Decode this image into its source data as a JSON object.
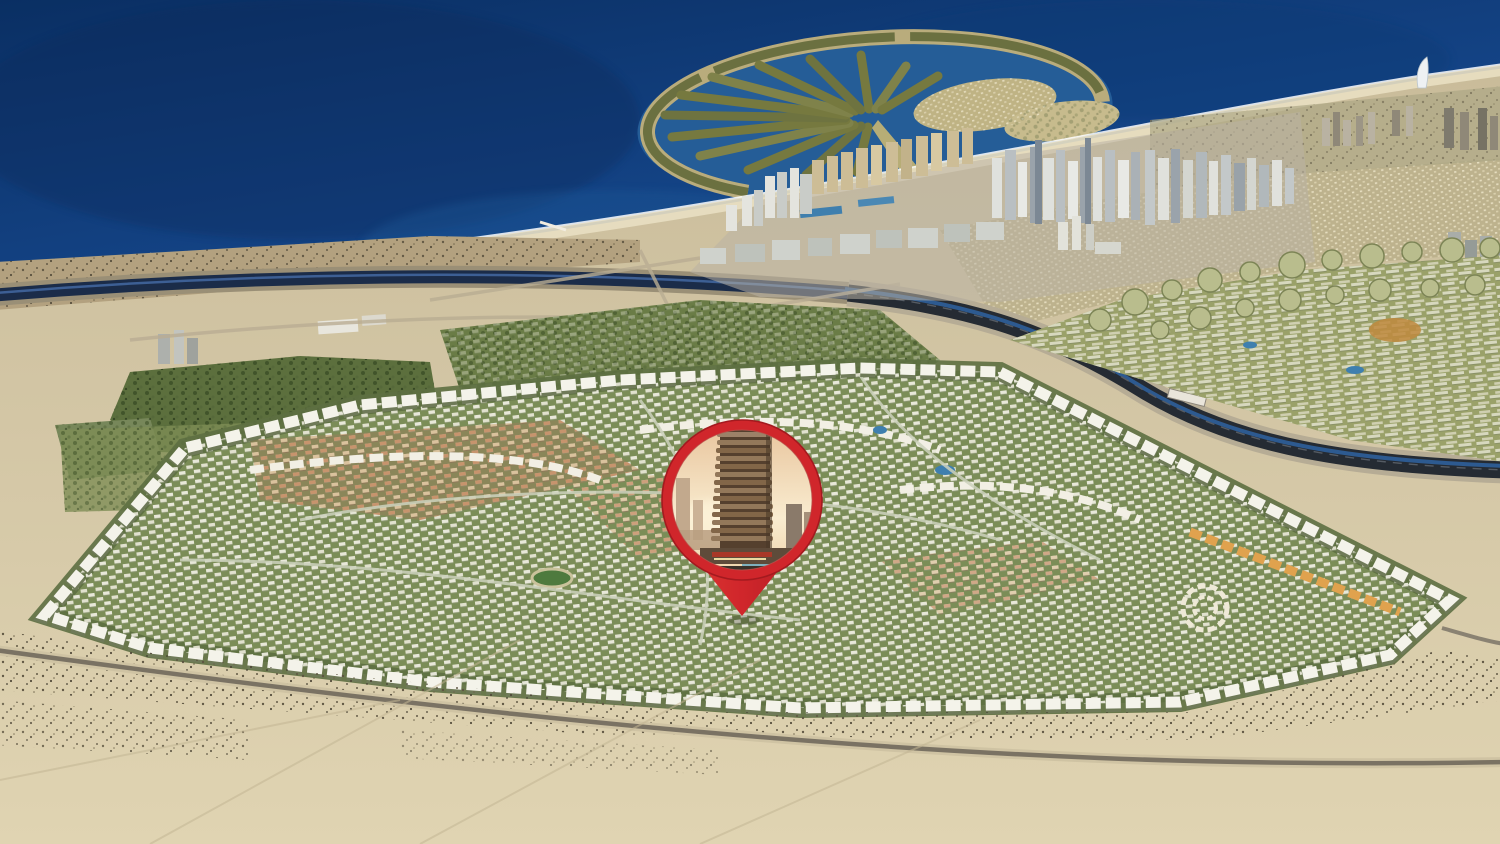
{
  "scene": {
    "type": "aerial-masterplan-render",
    "regions": [
      "deep-sea",
      "palm-shaped-island",
      "beach-shoreline",
      "city-skyline",
      "sail-shaped-hotel",
      "canal-highway",
      "desert-sand",
      "tree-belts",
      "large-villa-community",
      "row-villa-community",
      "circular-villa-clusters",
      "foreground-desert",
      "foreground-road"
    ],
    "marker": {
      "kind": "map-pin",
      "photo_subject": "high-rise-tower-at-sunset"
    }
  },
  "colors": {
    "sea_deep": "#0a2f63",
    "sea_mid": "#15468a",
    "sea_shallow": "#2b6aa6",
    "lagoon": "#255d97",
    "land_sand": "#d3c6a5",
    "sand_light": "#e0d4b2",
    "sand_dark": "#b3a17f",
    "beach": "#e9dfc2",
    "surf": "#ffffff",
    "scrub": "#5c5340",
    "forest_green": "#5c6f3d",
    "community_green": "#7b8d57",
    "community_olive": "#9aa169",
    "sprawl_tan": "#bdb28d",
    "building_white": "#f2f1e8",
    "building_tan": "#dcc39c",
    "building_terracotta": "#c89068",
    "amber_block": "#e0a24e",
    "canal_water": "#1b2c49",
    "highway_dark": "#252b33",
    "palm_frond": "#6e7340",
    "pin_red": "#d0262b",
    "pin_red_dark": "#a31a1f",
    "photo_sky_top": "#e8c49c",
    "photo_sky_glow": "#f9ecd0",
    "photo_tower_body": "#55402e",
    "photo_slab_a": "#93785a",
    "photo_slab_b": "#826648"
  }
}
